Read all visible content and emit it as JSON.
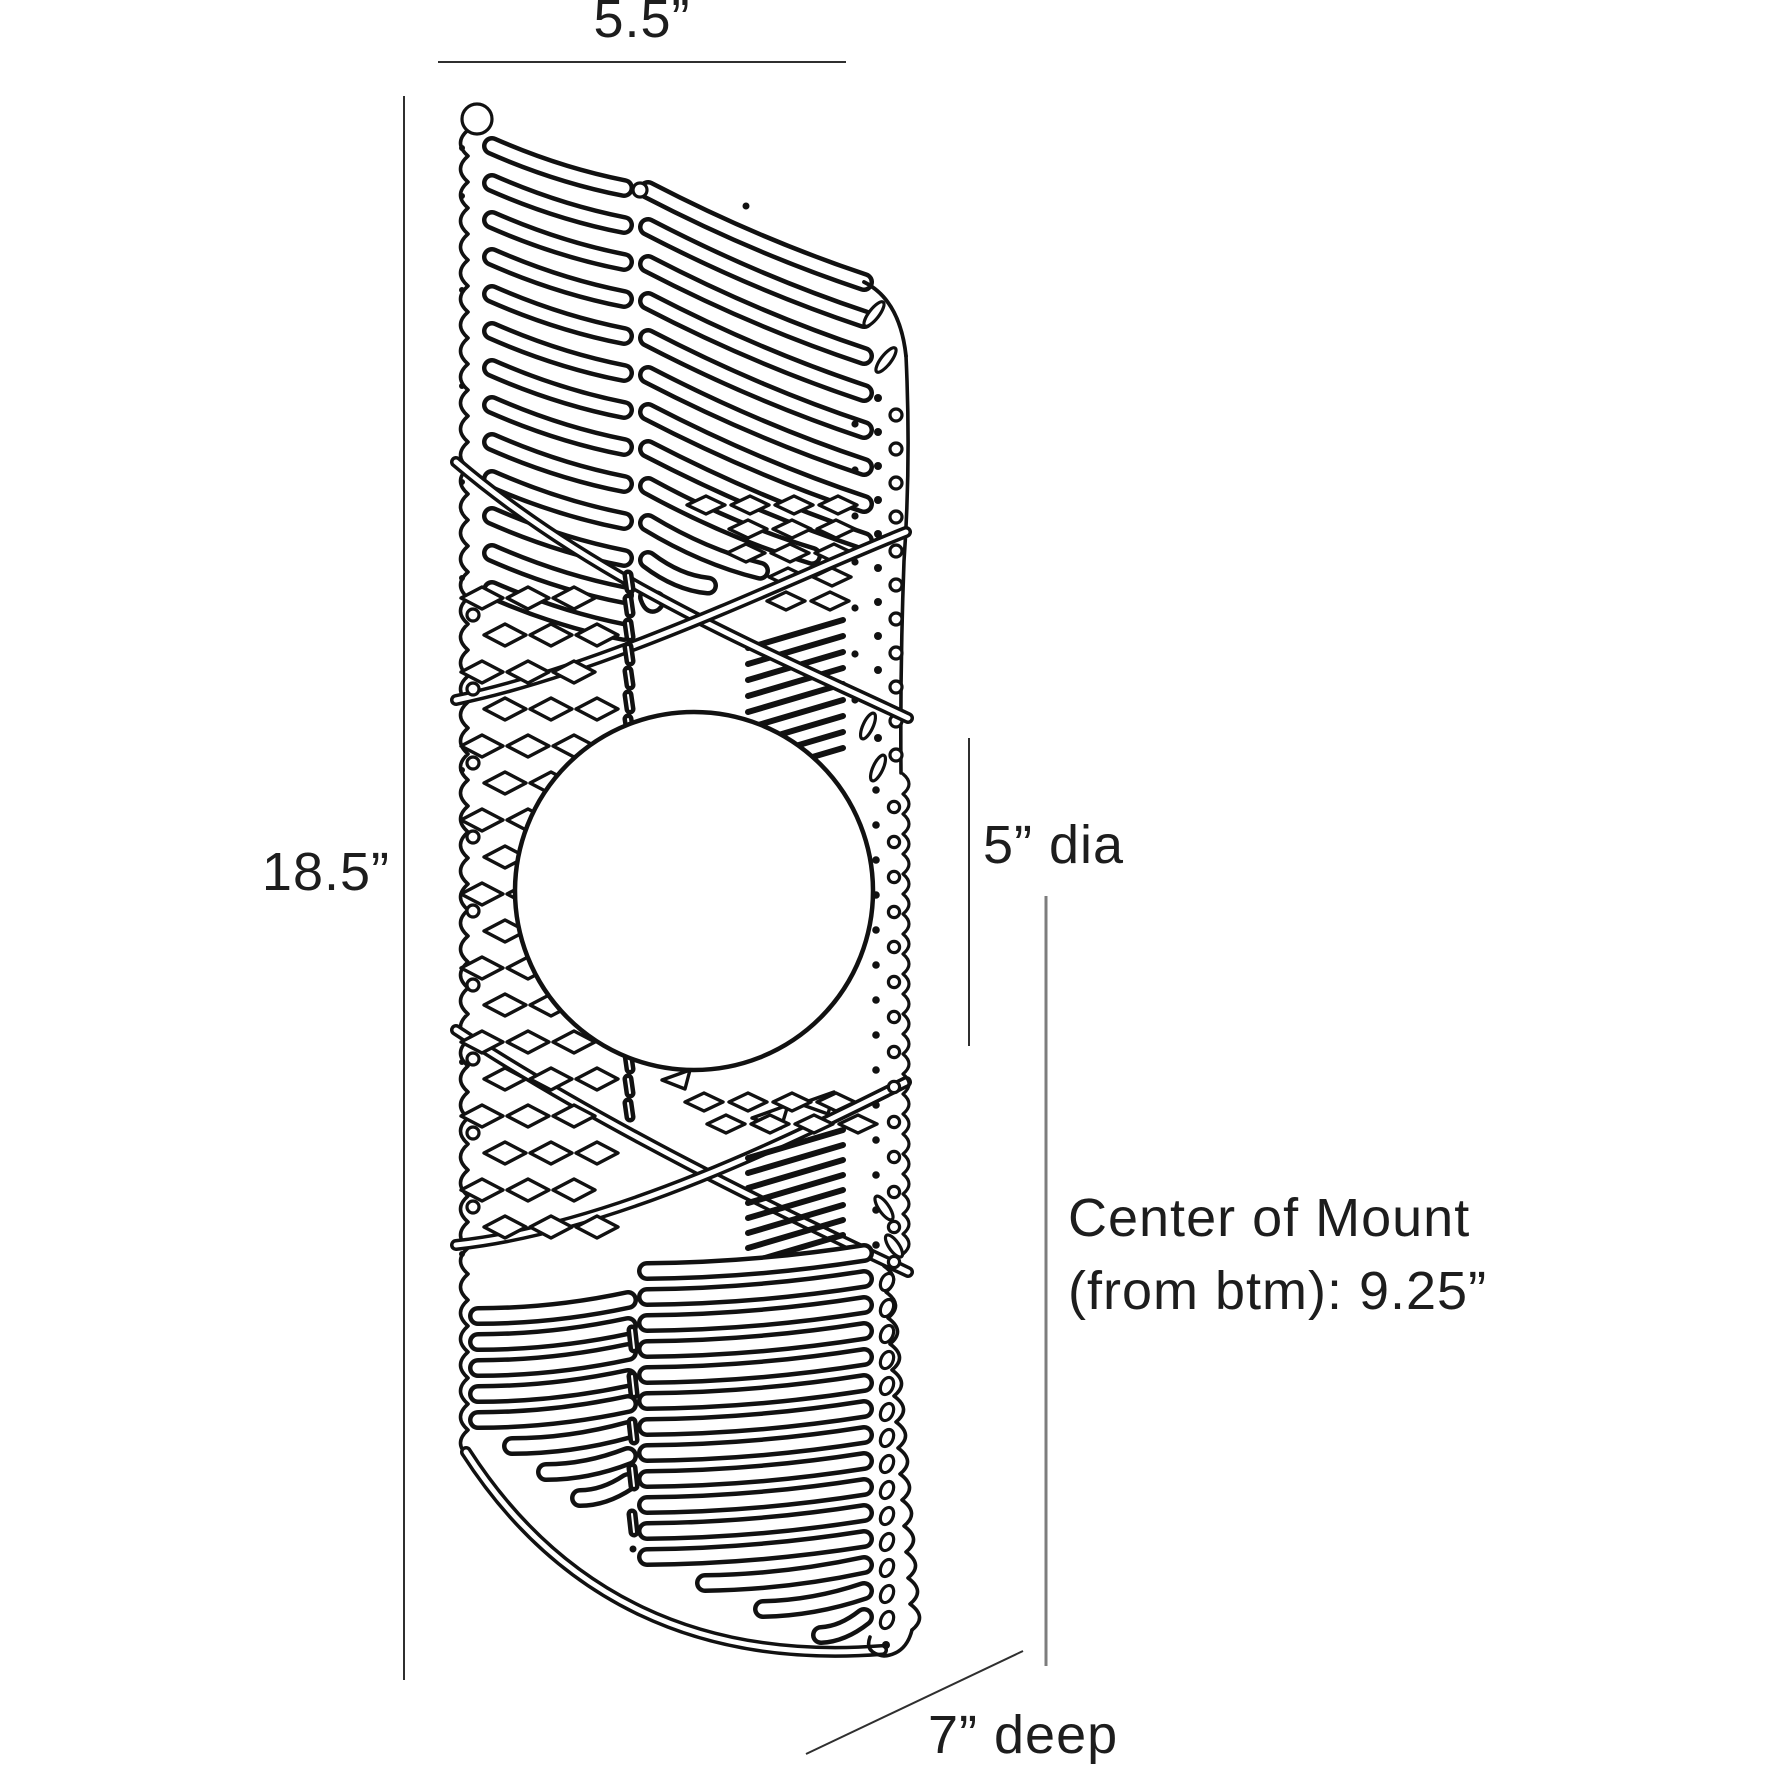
{
  "diagram": {
    "subject": "spiral-perforated-wall-sconce-with-globe-line-drawing",
    "dimensions": {
      "width": "5.5”",
      "height": "18.5”",
      "globe_diameter": "5” dia",
      "mount_line1": "Center of Mount",
      "mount_line2": "(from btm): 9.25”",
      "depth": "7” deep"
    }
  },
  "colors": {
    "ink": "#111111",
    "background": "#ffffff",
    "dimension_line": "#2f2f2f",
    "mount_line": "#7d7d7d",
    "label_text": "#1d1d1d"
  }
}
